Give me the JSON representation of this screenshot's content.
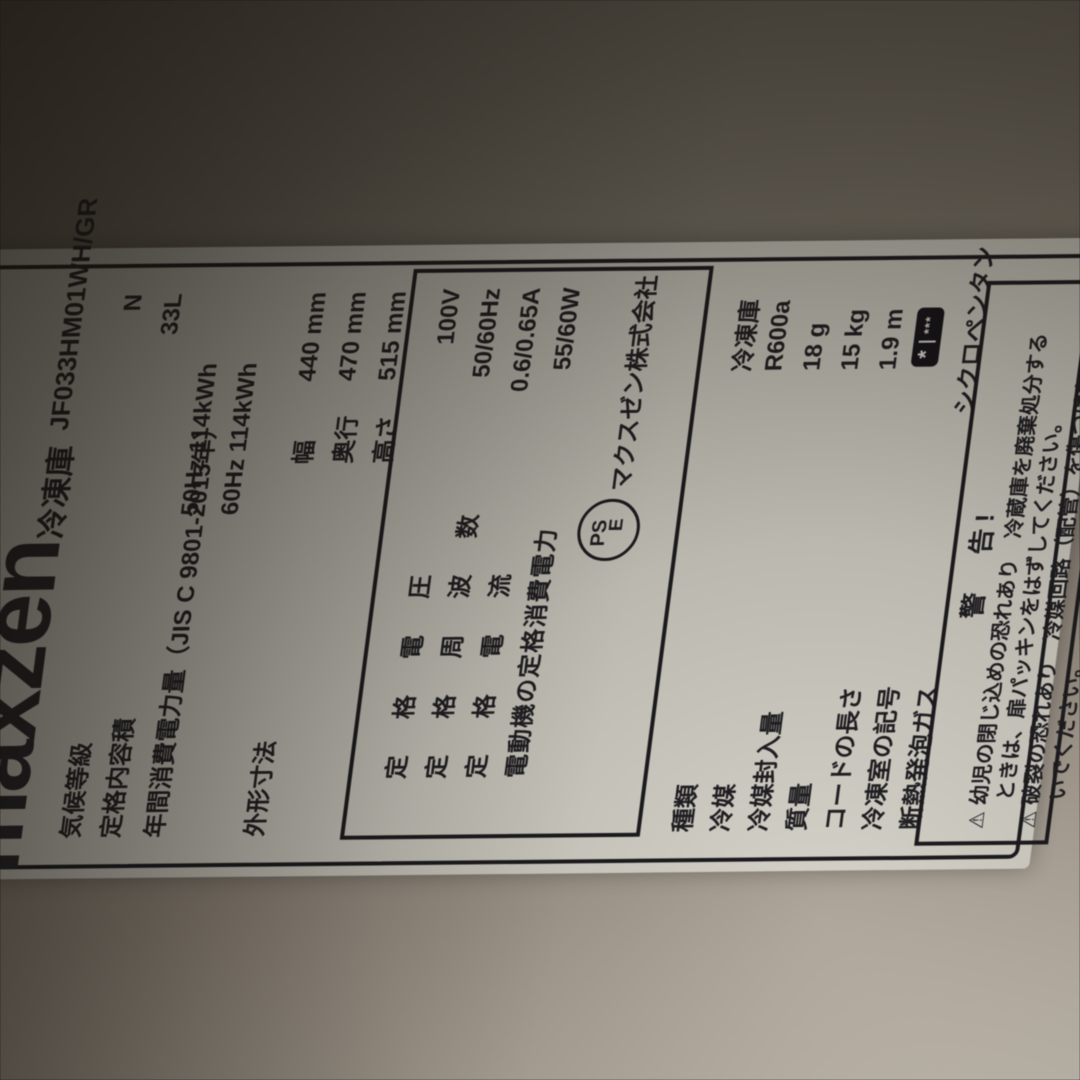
{
  "colors": {
    "label_bg": "#d9d6cd",
    "ink": "#201f23",
    "badge_bg": "#15141a",
    "badge_star": "#efede6"
  },
  "label": {
    "brand_logo": "maxzen",
    "category": "冷凍庫",
    "model": "JF033HM01WH/GR",
    "spec_rows": [
      {
        "name": "気候等級",
        "value": "N"
      },
      {
        "name": "定格内容積",
        "value": "33L"
      },
      {
        "name": "年間消費電力量（JIS C 9801-2015年）",
        "value_50hz": "50Hz 114kWh",
        "value_60hz": "60Hz 114kWh"
      }
    ],
    "dimensions": {
      "name": "外形寸法",
      "rows": [
        {
          "k": "幅",
          "v": "440 mm"
        },
        {
          "k": "奥行",
          "v": "470 mm"
        },
        {
          "k": "高さ",
          "v": "515 mm"
        }
      ]
    },
    "rating_box": {
      "rows": [
        {
          "name": "定　格　電　圧",
          "value": "100V"
        },
        {
          "name": "定　格　周　波　数",
          "value": "50/60Hz"
        },
        {
          "name": "定　格　電　流",
          "value": "0.6/0.65A"
        },
        {
          "name": "電動機の定格消費電力",
          "value": "55/60W"
        }
      ],
      "pse_top": "PS",
      "pse_bottom": "E",
      "company": "マクスゼン株式会社"
    },
    "detail_rows": [
      {
        "name": "種類",
        "value": "冷凍庫"
      },
      {
        "name": "冷媒",
        "value": "R600a"
      },
      {
        "name": "冷媒封入量",
        "value": "18 g"
      },
      {
        "name": "質量",
        "value": "15 kg"
      },
      {
        "name": "コードの長さ",
        "value": "1.9 m"
      },
      {
        "name": "冷凍室の記号",
        "value": ""
      },
      {
        "name": "断熱発泡ガス",
        "value": "シクロペンタン"
      }
    ],
    "freezer_symbol": {
      "large_star": "*",
      "small_stars": "***"
    },
    "warning": {
      "title": "警　告!",
      "icon": "⚠",
      "line1": "幼児の閉じ込めの恐れあり　冷蔵庫を廃棄処分する",
      "line2": "ときは、扉パッキンをはずしてください。",
      "icon2": "⚠",
      "line3": "破裂の恐れあり　冷媒回路（配管）を傷つけな",
      "line4": "いでください。"
    }
  }
}
